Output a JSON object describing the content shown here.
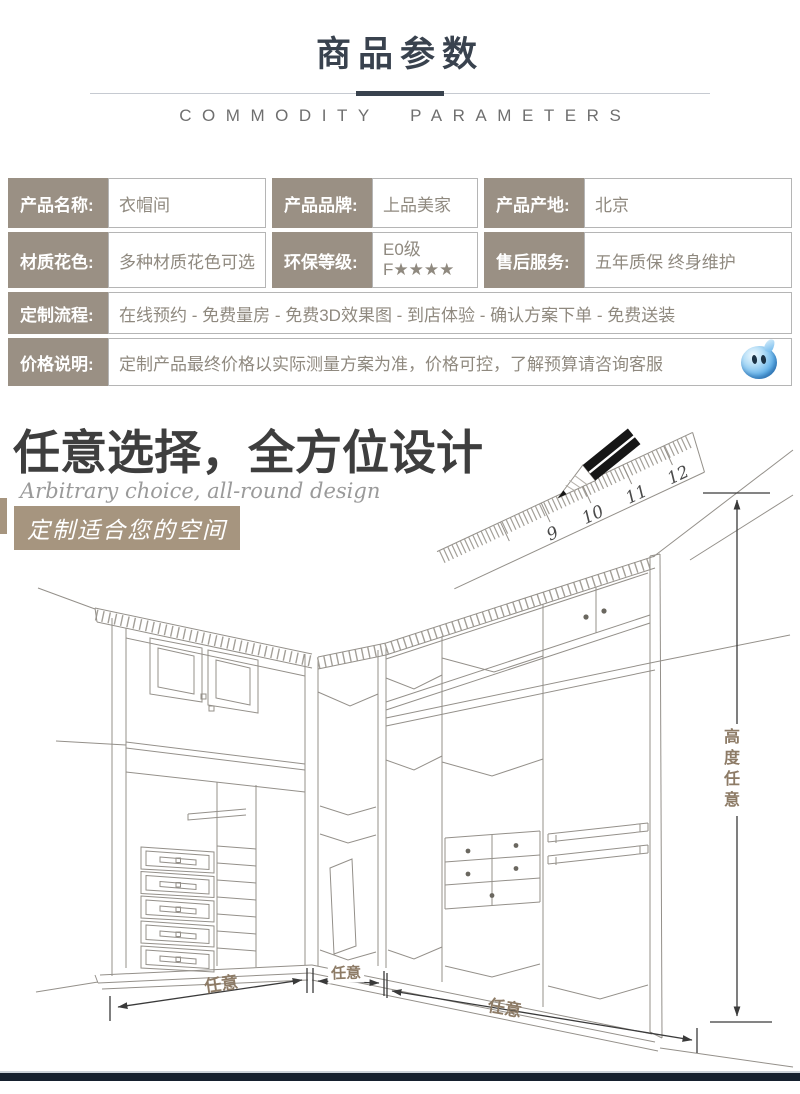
{
  "header": {
    "title": "商品参数",
    "subtitle": "COMMODITY PARAMETERS"
  },
  "spec_table": {
    "row1": {
      "c1_label": "产品名称:",
      "c1_value": "衣帽间",
      "c2_label": "产品品牌:",
      "c2_value": "上品美家",
      "c3_label": "产品产地:",
      "c3_value": "北京"
    },
    "row2": {
      "c1_label": "材质花色:",
      "c1_value": "多种材质花色可选",
      "c2_label": "环保等级:",
      "c2_value": "E0级\nF★★★★",
      "c3_label": "售后服务:",
      "c3_value": "五年质保 终身维护"
    },
    "row3": {
      "label": "定制流程:",
      "value": "在线预约 - 免费量房 - 免费3D效果图 - 到店体验 - 确认方案下单 - 免费送装"
    },
    "row4": {
      "label": "价格说明:",
      "value": "定制产品最终价格以实际测量方案为准，价格可控，了解预算请咨询客服",
      "service_icon": "qq-penguin-icon"
    }
  },
  "design_section": {
    "heading": "任意选择，全方位设计",
    "subheading": "Arbitrary choice, all-round design",
    "tagline": "定制适合您的空间",
    "ruler_numbers": {
      "n9": "9",
      "n10": "10",
      "n11": "11",
      "n12": "12"
    },
    "dimensions": {
      "width_left": "任意",
      "width_middle": "任意",
      "width_right": "任意",
      "height": "高度任意"
    }
  },
  "colors": {
    "accent": "#39424e",
    "label_bg": "#9a9084",
    "tagline_bg": "#a6957f",
    "dimension_label": "#8d7b66",
    "bottom_bar": "#16202e",
    "qq_blue": "#4aa9e9"
  }
}
